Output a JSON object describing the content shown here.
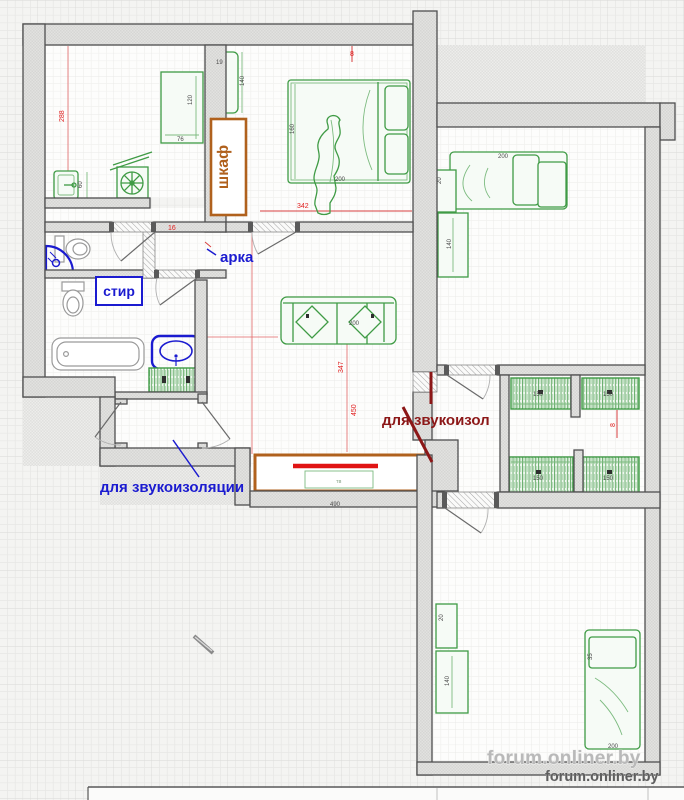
{
  "page": {
    "background": "#f4f4f2"
  },
  "annotations": {
    "wardrobe": "шкаф",
    "arch": "арка",
    "washer": "стир",
    "soundproof_blue": "для звукоизоляции",
    "soundproof_red": "для звукоизол",
    "console_text": "тв"
  },
  "watermark": {
    "large": "forum.onliner.by",
    "small": "forum.onliner.by"
  },
  "colors": {
    "annotation_blue": "#1b1bd0",
    "annotation_dark_red": "#8c1717",
    "wardrobe_brown": "#b0611d",
    "furniture_green": "#3f9b45",
    "dimension_red": "#e02020",
    "accent_red_bar": "#e01414",
    "wall_outline": "#4f4f4f"
  },
  "dimensions_red": [
    {
      "t": "288",
      "x": 64,
      "y": 122,
      "r": -90
    },
    {
      "t": "16",
      "x": 168,
      "y": 230
    },
    {
      "t": "342",
      "x": 297,
      "y": 208
    },
    {
      "t": "8",
      "x": 350,
      "y": 56
    },
    {
      "t": "347",
      "x": 343,
      "y": 373,
      "r": -90
    },
    {
      "t": "450",
      "x": 356,
      "y": 416,
      "r": -90
    },
    {
      "t": "8",
      "x": 615,
      "y": 427,
      "r": -90
    }
  ],
  "dimensions_black": [
    {
      "t": "120",
      "x": 192,
      "y": 105,
      "r": -90
    },
    {
      "t": "76",
      "x": 177,
      "y": 141
    },
    {
      "t": "60",
      "x": 82,
      "y": 188,
      "r": -90
    },
    {
      "t": "19",
      "x": 216,
      "y": 64
    },
    {
      "t": "140",
      "x": 244,
      "y": 86,
      "r": -90
    },
    {
      "t": "160",
      "x": 294,
      "y": 134,
      "r": -90
    },
    {
      "t": "200",
      "x": 335,
      "y": 181
    },
    {
      "t": "200",
      "x": 349,
      "y": 325
    },
    {
      "t": "200",
      "x": 498,
      "y": 158
    },
    {
      "t": "20",
      "x": 441,
      "y": 184,
      "r": -90
    },
    {
      "t": "140",
      "x": 451,
      "y": 249,
      "r": -90
    },
    {
      "t": "150",
      "x": 533,
      "y": 396
    },
    {
      "t": "150",
      "x": 603,
      "y": 396
    },
    {
      "t": "150",
      "x": 533,
      "y": 480
    },
    {
      "t": "150",
      "x": 603,
      "y": 480
    },
    {
      "t": "490",
      "x": 330,
      "y": 506
    },
    {
      "t": "20",
      "x": 443,
      "y": 621,
      "r": -90
    },
    {
      "t": "140",
      "x": 449,
      "y": 686,
      "r": -90
    },
    {
      "t": "35",
      "x": 592,
      "y": 660,
      "r": -90
    },
    {
      "t": "200",
      "x": 608,
      "y": 748
    }
  ]
}
